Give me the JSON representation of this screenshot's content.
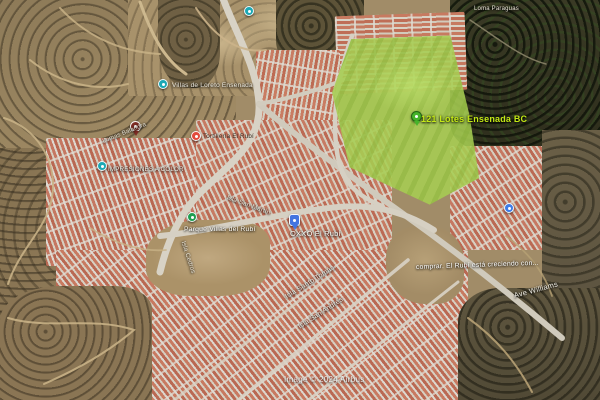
{
  "map": {
    "attribution": "Image © 2024 Airbus",
    "highlight_lot": {
      "label": "121 Lotes Ensenada BC",
      "label_color": "#c3e816",
      "fill_color": "#a6cd52"
    },
    "colors": {
      "lot_fill": "#a6cd52",
      "lot_label": "#c3e816",
      "pushpin_green": "#46b32a",
      "poi_teal": "#1ba8b5",
      "poi_red": "#e2493c",
      "pin_dark_red": "#7c2c24",
      "pin_blue": "#4274e0",
      "poi_green": "#1f9e50",
      "poi_blue": "#3d7ce6",
      "roof_terracotta": "#bf6e56",
      "road_gray": "#d8d2c5"
    },
    "markers": [
      {
        "name": "lot-pushpin-marker",
        "icon": "green-pushpin-icon",
        "type": "pushpin",
        "color": "#46b32a",
        "x": 411,
        "y": 111,
        "tail": true
      },
      {
        "name": "poi-marker-villas-loreto",
        "icon": "teal-poi-dot-icon",
        "type": "poi",
        "color": "#1ba8b5",
        "x": 158,
        "y": 79
      },
      {
        "name": "poi-marker-top-center",
        "icon": "teal-poi-dot-icon",
        "type": "poi",
        "color": "#1ba8b5",
        "x": 244,
        "y": 6
      },
      {
        "name": "poi-marker-impresiones",
        "icon": "teal-poi-dot-icon",
        "type": "poi",
        "color": "#1ba8b5",
        "x": 97,
        "y": 161
      },
      {
        "name": "saved-place-pin-marker",
        "icon": "dark-red-pin-icon",
        "type": "pin-dark",
        "color": "#7c2c24",
        "x": 130,
        "y": 121,
        "tail": true
      },
      {
        "name": "poi-marker-red",
        "icon": "red-poi-dot-icon",
        "type": "poi",
        "color": "#e2493c",
        "x": 191,
        "y": 131
      },
      {
        "name": "oxxo-store-pin-marker",
        "icon": "blue-shop-pin-icon",
        "type": "pin-blue",
        "color": "#4274e0",
        "x": 289,
        "y": 214,
        "tail": true
      },
      {
        "name": "park-poi-marker",
        "icon": "green-park-dot-icon",
        "type": "poi",
        "color": "#1f9e50",
        "x": 187,
        "y": 212
      },
      {
        "name": "poi-marker-right",
        "icon": "blue-poi-dot-icon",
        "type": "poi",
        "color": "#3d7ce6",
        "x": 504,
        "y": 203
      }
    ],
    "labels": [
      {
        "name": "lot-title-label",
        "text": "121 Lotes Ensenada BC",
        "x": 421,
        "y": 114,
        "size": 9,
        "color": "#c3e816",
        "weight": 700
      },
      {
        "name": "poi-label-villas-loreto",
        "text": "Villas de Loreto Ensenada",
        "x": 172,
        "y": 82,
        "size": 6.5,
        "color": "#efece2"
      },
      {
        "name": "area-label-lomas-balandra",
        "text": "Lomas Balandra",
        "x": 103,
        "y": 139,
        "size": 6,
        "color": "#e8e2d4",
        "rot": -22
      },
      {
        "name": "poi-label-impresiones",
        "text": "IMPRESIONES A COLOR",
        "x": 108,
        "y": 166,
        "size": 6.2,
        "color": "#f0ede4"
      },
      {
        "name": "poi-label-tortilleria",
        "text": "Tortillería El Rubí",
        "x": 203,
        "y": 133,
        "size": 6.2,
        "color": "#33291f",
        "dark": true
      },
      {
        "name": "poi-label-oxxo",
        "text": "OXXO El Rubí",
        "x": 290,
        "y": 229,
        "size": 7.5,
        "color": "#fdfbf5"
      },
      {
        "name": "poi-label-parque",
        "text": "Parque Villas del Rubí",
        "x": 184,
        "y": 226,
        "size": 6.8,
        "color": "#fdfbf5"
      },
      {
        "name": "street-label-isla-san-martin",
        "text": "Isla San Martín",
        "x": 227,
        "y": 194,
        "size": 6.4,
        "color": "#ece7da",
        "rot": 20
      },
      {
        "name": "street-label-isla-cedros",
        "text": "Isla Cedros",
        "x": 183,
        "y": 238,
        "size": 6.2,
        "color": "#ece7da",
        "rot": 72
      },
      {
        "name": "street-label-isla-santo-tomas",
        "text": "Isla Santo Tomás",
        "x": 286,
        "y": 294,
        "size": 7,
        "color": "#f2efe6",
        "rot": -32
      },
      {
        "name": "street-label-isla-san-andres",
        "text": "Isla San Andrés",
        "x": 299,
        "y": 324,
        "size": 7,
        "color": "#f2efe6",
        "rot": -33
      },
      {
        "name": "street-label-ave-williams",
        "text": "Ave Williams",
        "x": 514,
        "y": 291,
        "size": 7.5,
        "color": "#f2efe6",
        "rot": -15
      },
      {
        "name": "caption-el-rubi-creciendo",
        "text": "comprar. El Rubí está creciendo con...",
        "x": 416,
        "y": 264,
        "size": 6.8,
        "color": "#ffffff",
        "rot": -2
      },
      {
        "name": "area-label-loma-paraguas",
        "text": "Loma Paraguas",
        "x": 474,
        "y": 6,
        "size": 6,
        "color": "#efe9dc"
      }
    ]
  }
}
